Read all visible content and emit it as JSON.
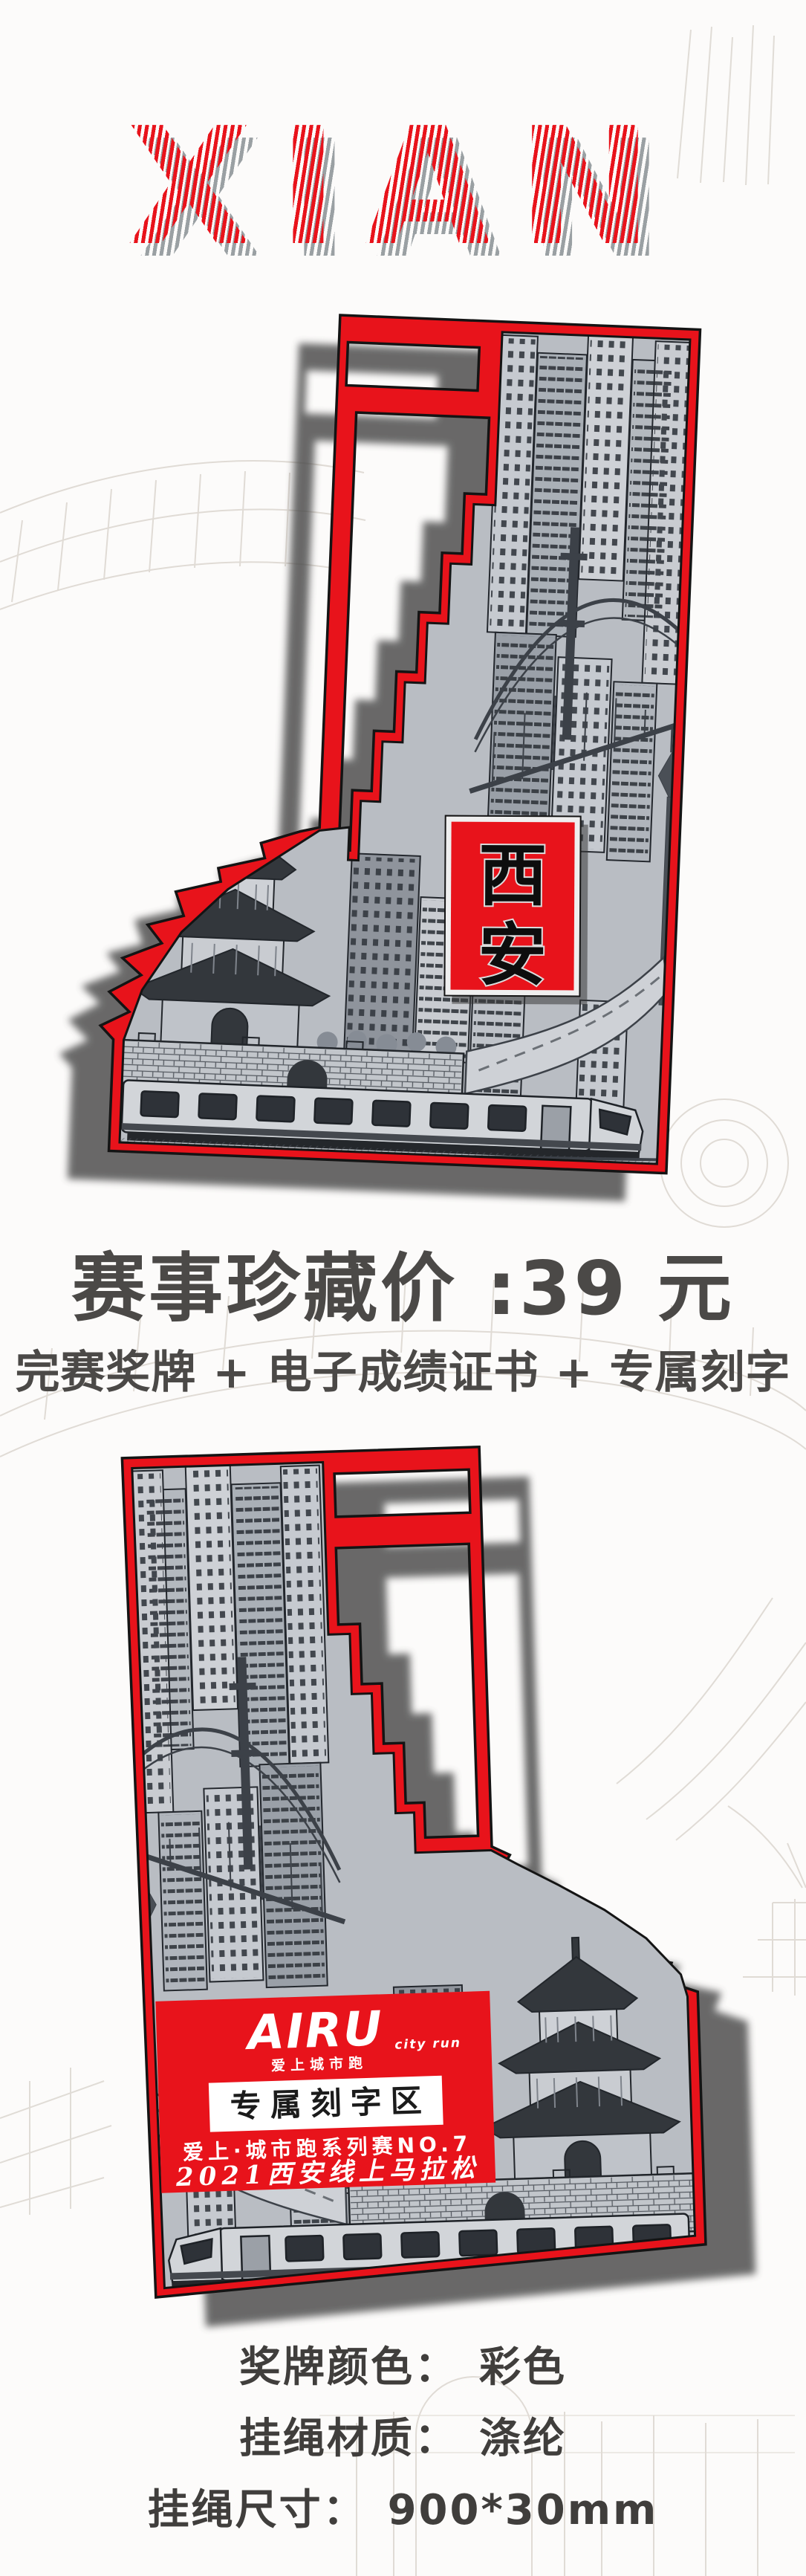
{
  "title": {
    "text": "XIAN"
  },
  "medal_front": {
    "badge": {
      "char_top": "西",
      "char_bottom": "安"
    }
  },
  "medal_back": {
    "logo": {
      "brand": "AIRU",
      "sub_right": "city run",
      "sub_below": "爱上城市跑"
    },
    "engrave_label": "专属刻字区",
    "series_line": "爱上·城市跑系列赛NO.7",
    "event_line": "2021西安线上马拉松"
  },
  "pricing": {
    "price_line": "赛事珍藏价 :39 元",
    "bundle_line": "完赛奖牌 + 电子成绩证书 + 专属刻字"
  },
  "specs": [
    {
      "label": "奖牌颜色：",
      "value": "彩色"
    },
    {
      "label": "挂绳材质：",
      "value": "涤纶"
    },
    {
      "label": "挂绳尺寸：",
      "value": "900*30mm"
    }
  ],
  "colors": {
    "accent_red": "#e8131b",
    "engraving_gray": "#b9bdc3",
    "line_art": "#2c3036",
    "text_dark": "#4b4947",
    "sketch": "#ddd8d2"
  }
}
